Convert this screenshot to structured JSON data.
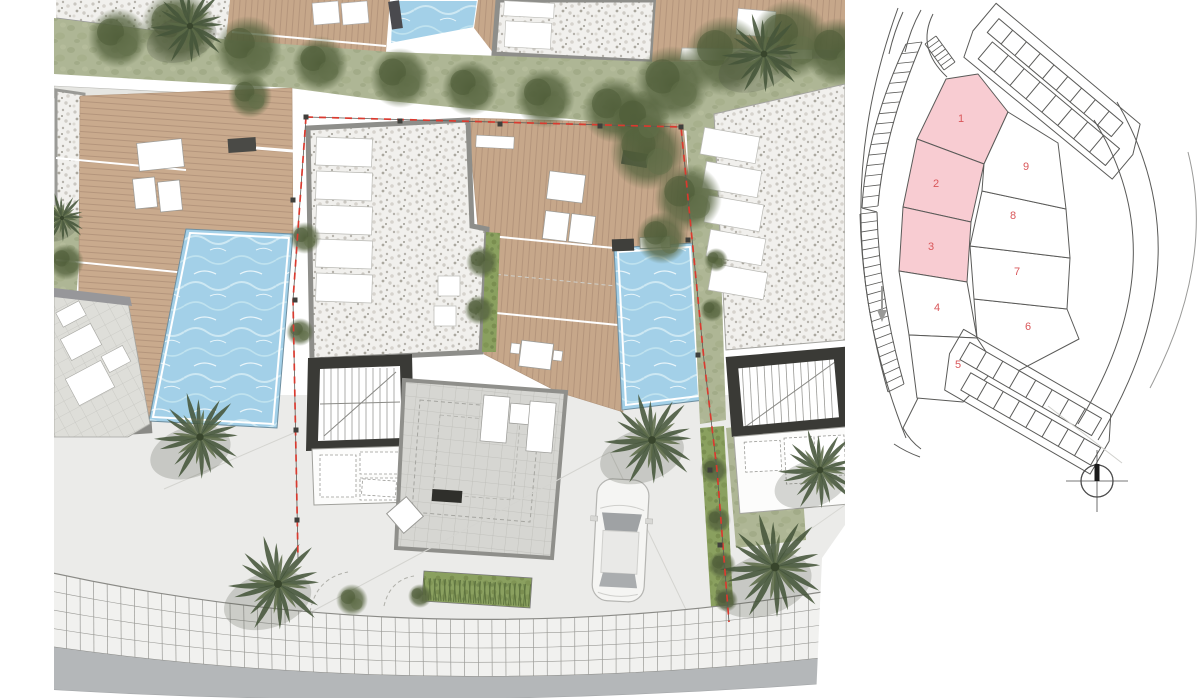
{
  "sheet": {
    "description": "Residential development masterplan sheet: detailed landscaped site plan of villas with pools on the left, location key plan with numbered plots on the right",
    "background": "#ffffff"
  },
  "main_plan": {
    "name": "detailed-site-plan",
    "colors": {
      "deck_wood": "#c9aa8d",
      "pool_water": "#a3d0e8",
      "pool_highlight": "#d8edf6",
      "gravel": "#f1f0ed",
      "lawn": "#aeb695",
      "hedge": "#8aa05f",
      "tree": "#55633e",
      "palm": "#46553a",
      "terrace_tile": "#d6d6d2",
      "road": "#b4b7b9",
      "sidewalk": "#f1f1ef",
      "pavement": "#ebebe9",
      "boundary_red": "#d93a2f",
      "wall_dark": "#3a3a36",
      "wall_gray": "#8e8e8a"
    },
    "objects": [
      "swimming pools",
      "timber decks",
      "sun loungers",
      "dining tables",
      "staircase cores",
      "roof skylights",
      "palm trees",
      "hedges",
      "white car",
      "tiled sidewalk",
      "curved road"
    ]
  },
  "key_plan": {
    "name": "location-key-plan",
    "highlight_color": "#f8ccd2",
    "plot_fill": "#ffffff",
    "number_color": "#d9575a",
    "line_color": "#5a5a58",
    "north_symbol": "compass-crosshair",
    "plots": [
      {
        "label": "1",
        "highlighted": true
      },
      {
        "label": "2",
        "highlighted": true
      },
      {
        "label": "3",
        "highlighted": true
      },
      {
        "label": "4",
        "highlighted": false
      },
      {
        "label": "5",
        "highlighted": false
      },
      {
        "label": "6",
        "highlighted": false
      },
      {
        "label": "7",
        "highlighted": false
      },
      {
        "label": "8",
        "highlighted": false
      },
      {
        "label": "9",
        "highlighted": false
      }
    ]
  }
}
